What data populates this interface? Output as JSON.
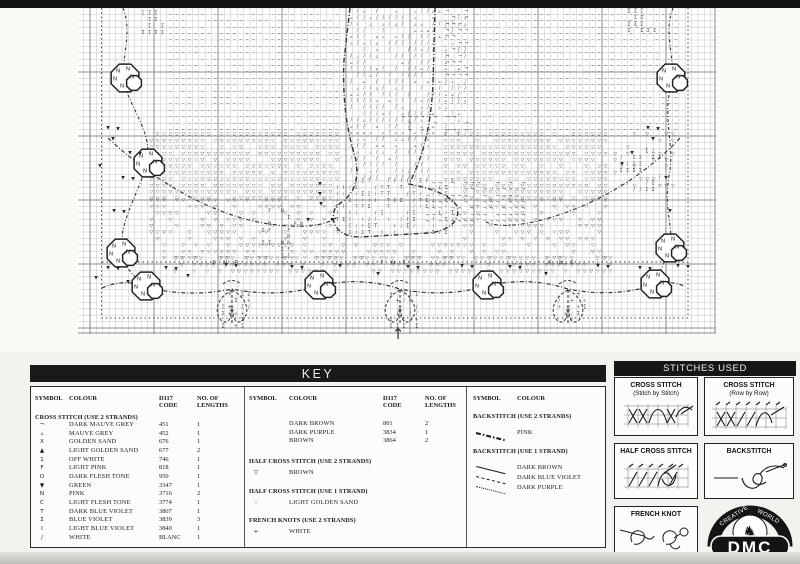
{
  "labels": {
    "key": "KEY",
    "stitches_used": "STITCHES USED"
  },
  "key": {
    "headers": {
      "symbol": "SYMBOL",
      "colour": "COLOUR",
      "code": "D117\nCODE",
      "lengths": "NO. OF\nLENGTHS"
    },
    "sections": {
      "cross_stitch": {
        "title": "CROSS STITCH (USE 2 STRANDS)",
        "rows": [
          {
            "symbol": "¬",
            "name": "DARK MAUVE GREY",
            "code": "451",
            "lengths": "1"
          },
          {
            "symbol": "▵",
            "name": "MAUVE GREY",
            "code": "452",
            "lengths": "1"
          },
          {
            "symbol": "X",
            "name": "GOLDEN SAND",
            "code": "676",
            "lengths": "1"
          },
          {
            "symbol": "▲",
            "name": "LIGHT GOLDEN SAND",
            "code": "677",
            "lengths": "2"
          },
          {
            "symbol": "1",
            "name": "OFF WHITE",
            "code": "746",
            "lengths": "1"
          },
          {
            "symbol": "F",
            "name": "LIGHT PINK",
            "code": "818",
            "lengths": "1"
          },
          {
            "symbol": "O",
            "name": "DARK FLESH TONE",
            "code": "950",
            "lengths": "1"
          },
          {
            "symbol": "▼",
            "name": "GREEN",
            "code": "3347",
            "lengths": "1"
          },
          {
            "symbol": "N",
            "name": "PINK",
            "code": "3716",
            "lengths": "2"
          },
          {
            "symbol": "C",
            "name": "LIGHT FLESH TONE",
            "code": "3774",
            "lengths": "1"
          },
          {
            "symbol": "T",
            "name": "DARK BLUE VIOLET",
            "code": "3807",
            "lengths": "1"
          },
          {
            "symbol": "Σ",
            "name": "BLUE VIOLET",
            "code": "3839",
            "lengths": "3"
          },
          {
            "symbol": "I",
            "name": "LIGHT BLUE VIOLET",
            "code": "3840",
            "lengths": "1"
          },
          {
            "symbol": "/",
            "name": "WHITE",
            "code": "BLANC",
            "lengths": "1"
          }
        ],
        "rows2": [
          {
            "symbol": "",
            "name": "DARK BROWN",
            "code": "801",
            "lengths": "2"
          },
          {
            "symbol": "",
            "name": "DARK PURPLE",
            "code": "3834",
            "lengths": "1"
          },
          {
            "symbol": "",
            "name": "BROWN",
            "code": "3864",
            "lengths": "2"
          }
        ]
      },
      "half_cross_2": {
        "title": "HALF CROSS STITCH (USE 2 STRANDS)",
        "rows": [
          {
            "symbol": "▽",
            "name": "BROWN"
          }
        ]
      },
      "half_cross_1": {
        "title": "HALF CROSS STITCH (USE 1 STRAND)",
        "rows": [
          {
            "symbol": "–",
            "name": "LIGHT GOLDEN SAND"
          }
        ]
      },
      "french_knots": {
        "title": "FRENCH KNOTS (USE 2 STRANDS)",
        "rows": [
          {
            "symbol": "+",
            "name": "WHITE"
          }
        ]
      },
      "backstitch_2": {
        "title": "BACKSTITCH (USE 2 STRANDS)",
        "rows": [
          {
            "line": "dashdot",
            "name": "PINK"
          }
        ]
      },
      "backstitch_1": {
        "title": "BACKSTITCH (USE 1 STRAND)",
        "rows": [
          {
            "line": "solid",
            "name": "DARK BROWN"
          },
          {
            "line": "dashed",
            "name": "DARK BLUE VIOLET"
          },
          {
            "line": "dotted",
            "name": "DARK PURPLE"
          }
        ]
      }
    }
  },
  "stitches_used": {
    "boxes": [
      {
        "title": "CROSS STITCH",
        "subtitle": "(Stitch by Stitch)"
      },
      {
        "title": "CROSS STITCH",
        "subtitle": "(Row by Row)"
      },
      {
        "title": "HALF CROSS STITCH",
        "subtitle": ""
      },
      {
        "title": "BACKSTITCH",
        "subtitle": ""
      },
      {
        "title": "FRENCH KNOT",
        "subtitle": ""
      }
    ],
    "logo": {
      "brand": "DMC",
      "arc_text_left": "CREATIVE",
      "arc_text_right": "WORLD"
    }
  },
  "colors": {
    "ink": "#2a2a2a",
    "grid_minor": "#c9c9c9",
    "grid_major": "#8c8c8c",
    "bar_bg": "#161616"
  },
  "chart": {
    "cell": 6.4,
    "width": 638,
    "height": 326,
    "arrow_glyph": "↑",
    "figure_mask": [
      [
        258,
        0,
        104,
        172
      ],
      [
        250,
        172,
        132,
        56
      ]
    ],
    "fields": [
      {
        "x": 89,
        "y": 3,
        "w": 508,
        "h": 126,
        "chars": [
          "–"
        ],
        "skip": 0.2,
        "masked": true
      },
      {
        "x": 70,
        "y": 123,
        "w": 460,
        "h": 66,
        "chars": [
          "▽"
        ],
        "skip": 0.15,
        "masked": true
      },
      {
        "x": 70,
        "y": 189,
        "w": 460,
        "h": 58,
        "chars": [
          "▽"
        ],
        "skip": 0.5,
        "masked": true
      },
      {
        "x": 94,
        "y": 247,
        "w": 440,
        "h": 14,
        "chars": [
          "▽"
        ],
        "skip": 0.3,
        "masked": true
      },
      {
        "x": 534,
        "y": 123,
        "w": 64,
        "h": 56,
        "chars": [
          "▽"
        ],
        "skip": 0.75,
        "masked": false
      },
      {
        "x": 270,
        "y": 0,
        "w": 82,
        "h": 170,
        "chars": [
          "/",
          "/",
          "▵"
        ],
        "skip": 0.3,
        "masked": false
      },
      {
        "x": 256,
        "y": 170,
        "w": 118,
        "h": 52,
        "chars": [
          "Σ",
          "I",
          "T",
          "/"
        ],
        "skip": 0.35,
        "masked": false
      },
      {
        "x": 352,
        "y": 0,
        "w": 36,
        "h": 128,
        "chars": [
          "/",
          "▵"
        ],
        "skip": 0.5,
        "masked": false
      },
      {
        "x": 366,
        "y": 0,
        "w": 22,
        "h": 64,
        "chars": [
          "¬"
        ],
        "skip": 0.45,
        "masked": false
      },
      {
        "x": 346,
        "y": 172,
        "w": 100,
        "h": 44,
        "chars": [
          "¬"
        ],
        "skip": 0.3,
        "masked": false
      },
      {
        "x": 322,
        "y": 106,
        "w": 64,
        "h": 18,
        "chars": [
          "¬"
        ],
        "skip": 0.45,
        "masked": false
      },
      {
        "x": 62,
        "y": 2,
        "w": 22,
        "h": 22,
        "chars": [
          "Σ"
        ],
        "skip": 0.35,
        "masked": false
      },
      {
        "x": 548,
        "y": 0,
        "w": 26,
        "h": 24,
        "chars": [
          "Σ"
        ],
        "skip": 0.4,
        "masked": false
      },
      {
        "x": 540,
        "y": 140,
        "w": 44,
        "h": 42,
        "chars": [
          "Σ",
          "/"
        ],
        "skip": 0.6,
        "masked": false
      },
      {
        "x": 182,
        "y": 200,
        "w": 42,
        "h": 46,
        "chars": [
          "Σ",
          "F",
          "N"
        ],
        "skip": 0.6,
        "masked": false
      },
      {
        "x": 142,
        "y": 283,
        "w": 26,
        "h": 34,
        "chars": [
          "Σ",
          "/",
          "+"
        ],
        "skip": 0.5,
        "masked": false
      },
      {
        "x": 310,
        "y": 283,
        "w": 26,
        "h": 34,
        "chars": [
          "Σ",
          "/",
          "+"
        ],
        "skip": 0.5,
        "masked": false
      },
      {
        "x": 478,
        "y": 283,
        "w": 26,
        "h": 34,
        "chars": [
          "Σ",
          "/",
          "+"
        ],
        "skip": 0.5,
        "masked": false
      }
    ],
    "octagons": [
      [
        47,
        70
      ],
      [
        70,
        155
      ],
      [
        43,
        245
      ],
      [
        68,
        278
      ],
      [
        241,
        277
      ],
      [
        409,
        277
      ],
      [
        577,
        276
      ],
      [
        593,
        70
      ],
      [
        592,
        240
      ]
    ],
    "sprigs": [
      [
        30,
        120
      ],
      [
        40,
        121
      ],
      [
        35,
        131
      ],
      [
        52,
        145
      ],
      [
        62,
        146
      ],
      [
        22,
        158
      ],
      [
        45,
        170
      ],
      [
        55,
        171
      ],
      [
        36,
        203
      ],
      [
        46,
        204
      ],
      [
        30,
        260
      ],
      [
        40,
        261
      ],
      [
        18,
        270
      ],
      [
        50,
        274
      ],
      [
        88,
        260
      ],
      [
        98,
        261
      ],
      [
        110,
        268
      ],
      [
        148,
        257
      ],
      [
        158,
        258
      ],
      [
        214,
        259
      ],
      [
        224,
        260
      ],
      [
        262,
        258
      ],
      [
        300,
        266
      ],
      [
        330,
        259
      ],
      [
        340,
        260
      ],
      [
        384,
        258
      ],
      [
        394,
        259
      ],
      [
        432,
        259
      ],
      [
        442,
        260
      ],
      [
        468,
        266
      ],
      [
        520,
        258
      ],
      [
        530,
        259
      ],
      [
        562,
        260
      ],
      [
        572,
        261
      ],
      [
        570,
        120
      ],
      [
        580,
        121
      ],
      [
        575,
        131
      ],
      [
        554,
        145
      ],
      [
        544,
        156
      ],
      [
        588,
        170
      ],
      [
        592,
        203
      ],
      [
        242,
        176
      ],
      [
        242,
        186
      ],
      [
        243,
        196
      ],
      [
        230,
        212
      ],
      [
        254,
        212
      ],
      [
        600,
        258
      ],
      [
        610,
        259
      ]
    ],
    "fnf_labels": [
      [
        136,
        255
      ],
      [
        304,
        255
      ],
      [
        472,
        255
      ]
    ],
    "fnf_text": [
      "F",
      "N",
      "F"
    ],
    "swags": {
      "clusters": [
        154,
        322,
        490
      ]
    },
    "paths": [
      {
        "d": "M272,0 L266,52 C264,96 270,126 278,152 C281,176 275,188 258,198 C250,216 261,229 282,229 L350,225 C372,223 383,212 379,198 C371,186 352,180 331,176 C346,147 353,116 355,76 L357,0",
        "dash": [
          5,
          2,
          1,
          2
        ],
        "w": 1.4
      },
      {
        "d": "M24,280 Q46,270 68,279 Q110,290 154,281 Q200,290 241,278 Q282,268 322,281 Q366,290 409,278 Q450,268 490,281 Q534,290 577,277 Q592,272 606,278",
        "dash": [
          4,
          2,
          1,
          2
        ],
        "w": 1.2
      },
      {
        "d": "M30,130 C75,172 130,205 185,215 C215,220 243,220 258,210",
        "dash": [
          4,
          2,
          1,
          2
        ],
        "w": 1.1
      },
      {
        "d": "M602,130 C565,170 510,202 455,214 C435,218 420,219 408,214",
        "dash": [
          4,
          2,
          1,
          2
        ],
        "w": 1.1
      },
      {
        "d": "M45,0 C56,28 40,52 48,82 C58,108 74,128 69,154 C62,184 40,214 44,244 C47,262 58,270 66,277",
        "dash": [
          3,
          2,
          1,
          2
        ],
        "w": 1.1
      },
      {
        "d": "M595,0 C584,28 600,52 592,82 C585,112 597,140 591,168 C585,204 597,222 591,238 C586,258 580,268 577,275",
        "dash": [
          3,
          2,
          1,
          2
        ],
        "w": 1.1
      },
      {
        "d": "M24,254 L610,254",
        "dash": [
          1.5,
          3
        ],
        "w": 1
      }
    ]
  }
}
